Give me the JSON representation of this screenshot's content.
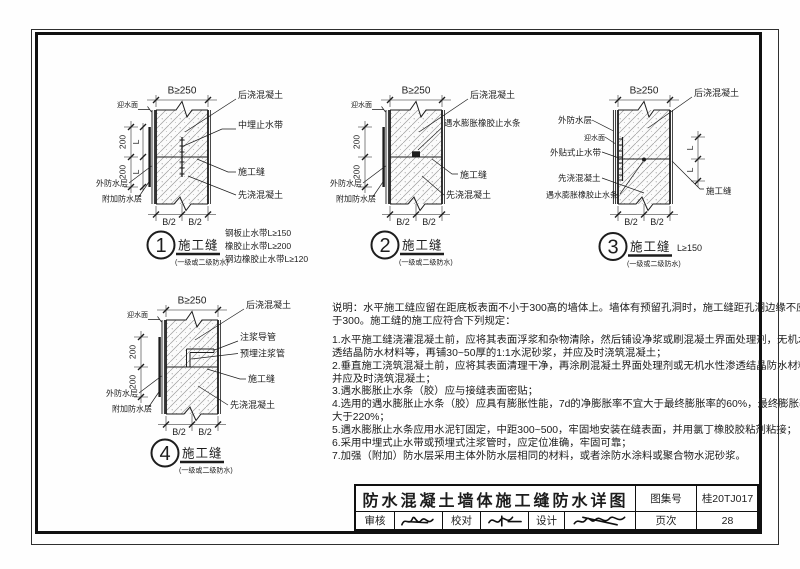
{
  "details": [
    {
      "number": "1",
      "dim_top": "B≥250",
      "dim_b_left": "B/2",
      "dim_b_right": "B/2",
      "dim_200_top": "200",
      "dim_200_bottom": "200",
      "dim_l_top": "L",
      "dim_l_bottom": "L",
      "water_face": "迎水面",
      "label_post": "后浇混凝土",
      "label_mid_waterstop": "中埋止水带",
      "label_joint": "施工缝",
      "label_pre": "先浇混凝土",
      "label_outer_wp": "外防水层",
      "label_add_wp": "附加防水层",
      "caption": "施工缝",
      "subcaption": "(一级或二级防水)",
      "side_notes": [
        "钢板止水带L≥150",
        "橡胶止水带L≥200",
        "钢边橡胶止水带L≥120"
      ]
    },
    {
      "number": "2",
      "dim_top": "B≥250",
      "dim_b_left": "B/2",
      "dim_b_right": "B/2",
      "dim_200_top": "200",
      "dim_200_bottom": "200",
      "water_face": "迎水面",
      "label_post": "后浇混凝土",
      "label_swell_strip": "遇水膨胀橡胶止水条",
      "label_joint": "施工缝",
      "label_pre": "先浇混凝土",
      "label_outer_wp": "外防水层",
      "label_add_wp": "附加防水层",
      "caption": "施工缝",
      "subcaption": "(一级或二级防水)"
    },
    {
      "number": "3",
      "dim_top": "B≥250",
      "dim_b_left": "B/2",
      "dim_b_right": "B/2",
      "dim_l_top": "L",
      "dim_l_bottom": "L",
      "water_face": "迎水面",
      "label_post": "后浇混凝土",
      "label_outer_wp": "外防水层",
      "label_ext_waterstop": "外贴式止水带",
      "label_pre": "先浇混凝土",
      "label_swell_strip": "遇水膨胀橡胶止水条",
      "label_joint": "施工缝",
      "caption": "施工缝",
      "caption_note": "L≥150",
      "subcaption": "(一级或二级防水)"
    },
    {
      "number": "4",
      "dim_top": "B≥250",
      "dim_b_left": "B/2",
      "dim_b_right": "B/2",
      "dim_200_top": "200",
      "dim_200_bottom": "200",
      "water_face": "迎水面",
      "label_post": "后浇混凝土",
      "label_grout_guide": "注浆导管",
      "label_grout_pipe": "预埋注浆管",
      "label_joint": "施工缝",
      "label_pre": "先浇混凝土",
      "label_outer_wp": "外防水层",
      "label_add_wp": "附加防水层",
      "caption": "施工缝",
      "subcaption": "(一级或二级防水)"
    }
  ],
  "notes": {
    "lines": [
      "说明：水平施工缝应留在距底板表面不小于300高的墙体上。墙体有预留孔洞时，施工缝距孔洞边缘不应少",
      "于300。施工缝的施工应符合下列规定：",
      "1.水平施工缝浇灌混凝土前，应将其表面浮浆和杂物清除，然后铺设净浆或刷混凝土界面处理剂，无机水性渗",
      "透结晶防水材料等，再铺30~50厚的1:1水泥砂浆，并应及时浇筑混凝土；",
      "2.垂直施工浇筑混凝土前，应将其表面清理干净，再涂刷混凝土界面处理剂或无机水性渗透结晶防水材料，",
      "并应及时浇筑混凝土；",
      "3.遇水膨胀止水条（胶）应与接缝表面密贴；",
      "4.选用的遇水膨胀止水条（胶）应具有膨胀性能，7d的净膨胀率不宜大于最终膨胀率的60%，最终膨胀率不",
      "大于220%；",
      "5.遇水膨胀止水条应用水泥钉固定，中距300~500，牢固地安装在缝表面，并用氯丁橡胶胶粘剂粘接；",
      "6.采用中埋式止水带或预埋式注浆管时，应定位准确，牢固可靠；",
      "7.加强（附加）防水层采用主体外防水层相同的材料，或者涂防水涂料或聚合物水泥砂浆。"
    ]
  },
  "titleblock": {
    "title": "防水混凝土墙体施工缝防水详图",
    "atlas_label": "图集号",
    "atlas_no": "桂20TJ017",
    "review_label": "审核",
    "proof_label": "校对",
    "design_label": "设计",
    "page_label": "页次",
    "page_no": "28"
  }
}
